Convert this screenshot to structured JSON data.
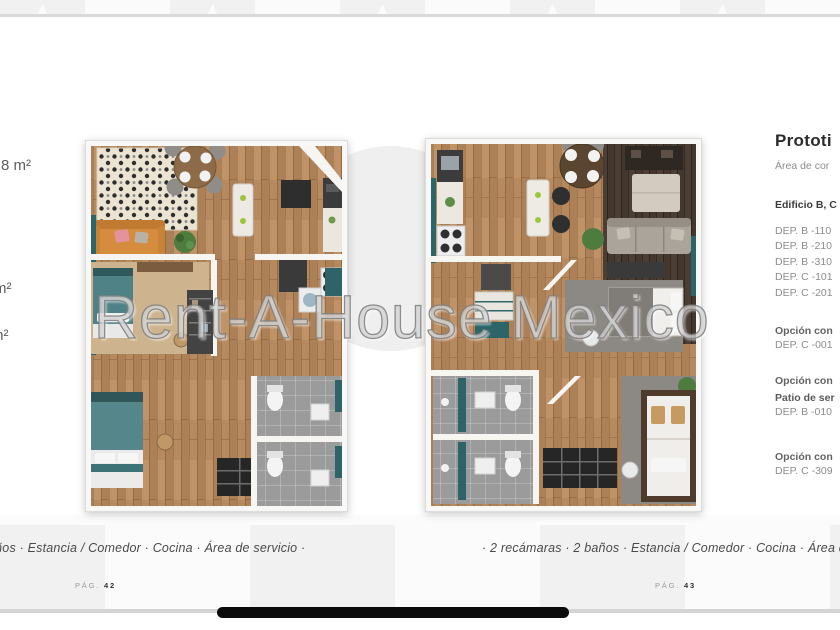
{
  "page": {
    "watermark": "Rent-A-House Mexico"
  },
  "left_plan": {
    "area_label_1": "8 m²",
    "area_label_2": "m²",
    "area_label_3": "m²",
    "caption": "años · Estancia / Comedor · Cocina · Área de servicio ·",
    "page_label": "PÁG.",
    "page_number": "42"
  },
  "right_plan": {
    "caption": "· 2 recámaras · 2 baños · Estancia / Comedor · Cocina · Área de s",
    "page_label": "PÁG.",
    "page_number": "43"
  },
  "info_panel": {
    "title": "Prototi",
    "subtitle": "Área de cor",
    "building_heading": "Edificio B, C",
    "departments": [
      "DEP. B -110",
      "DEP. B -210",
      "DEP. B -310",
      "DEP. C -101",
      "DEP. C -201"
    ],
    "option_1": {
      "label": "Opción con",
      "dep": "DEP. C -001"
    },
    "option_2": {
      "label": "Opción con",
      "patio": "Patio de ser",
      "dep": "DEP. B -010"
    },
    "option_3": {
      "label": "Opción con",
      "dep": "DEP. C -309"
    }
  },
  "colors": {
    "teal_accent": "#2c6468",
    "teal_bed": "#538689",
    "orange_sofa": "#d68c3f",
    "wood_floor": "#b6895f",
    "dark_wood_floor": "#4b3e34",
    "bath_tile": "#9a9a9a",
    "watermark_gray": "#9b9b9b",
    "rule_gray": "#d9d9d9"
  }
}
